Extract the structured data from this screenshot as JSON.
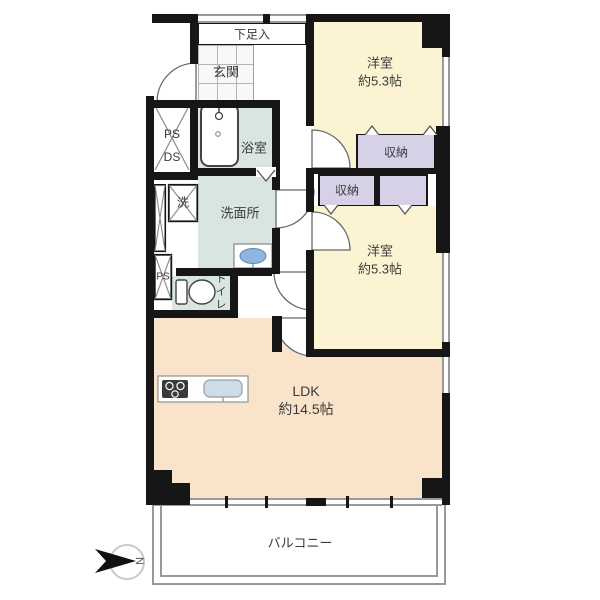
{
  "floorplan": {
    "rooms": {
      "shoe_closet": "下足入",
      "entrance": "玄関",
      "ps_ds_line1": "PS",
      "ps_ds_line2": "DS",
      "bathroom": "浴室",
      "washer": "洗",
      "washroom": "洗面所",
      "ps": "PS",
      "toilet": "トイレ",
      "closet1": "収納",
      "closet2": "収納",
      "bedroom1_name": "洋室",
      "bedroom1_size": "約5.3帖",
      "bedroom2_name": "洋室",
      "bedroom2_size": "約5.3帖",
      "ldk_name": "LDK",
      "ldk_size": "約14.5帖",
      "balcony": "バルコニー"
    },
    "compass": {
      "north": "N"
    },
    "colors": {
      "bedroom": "#fcf3d2",
      "ldk": "#fae3cb",
      "closet": "#d7d1e7",
      "wet_area": "#d9e5e3",
      "wall": "#161616",
      "window": "#999999",
      "sink": "#8fb6e0"
    }
  }
}
